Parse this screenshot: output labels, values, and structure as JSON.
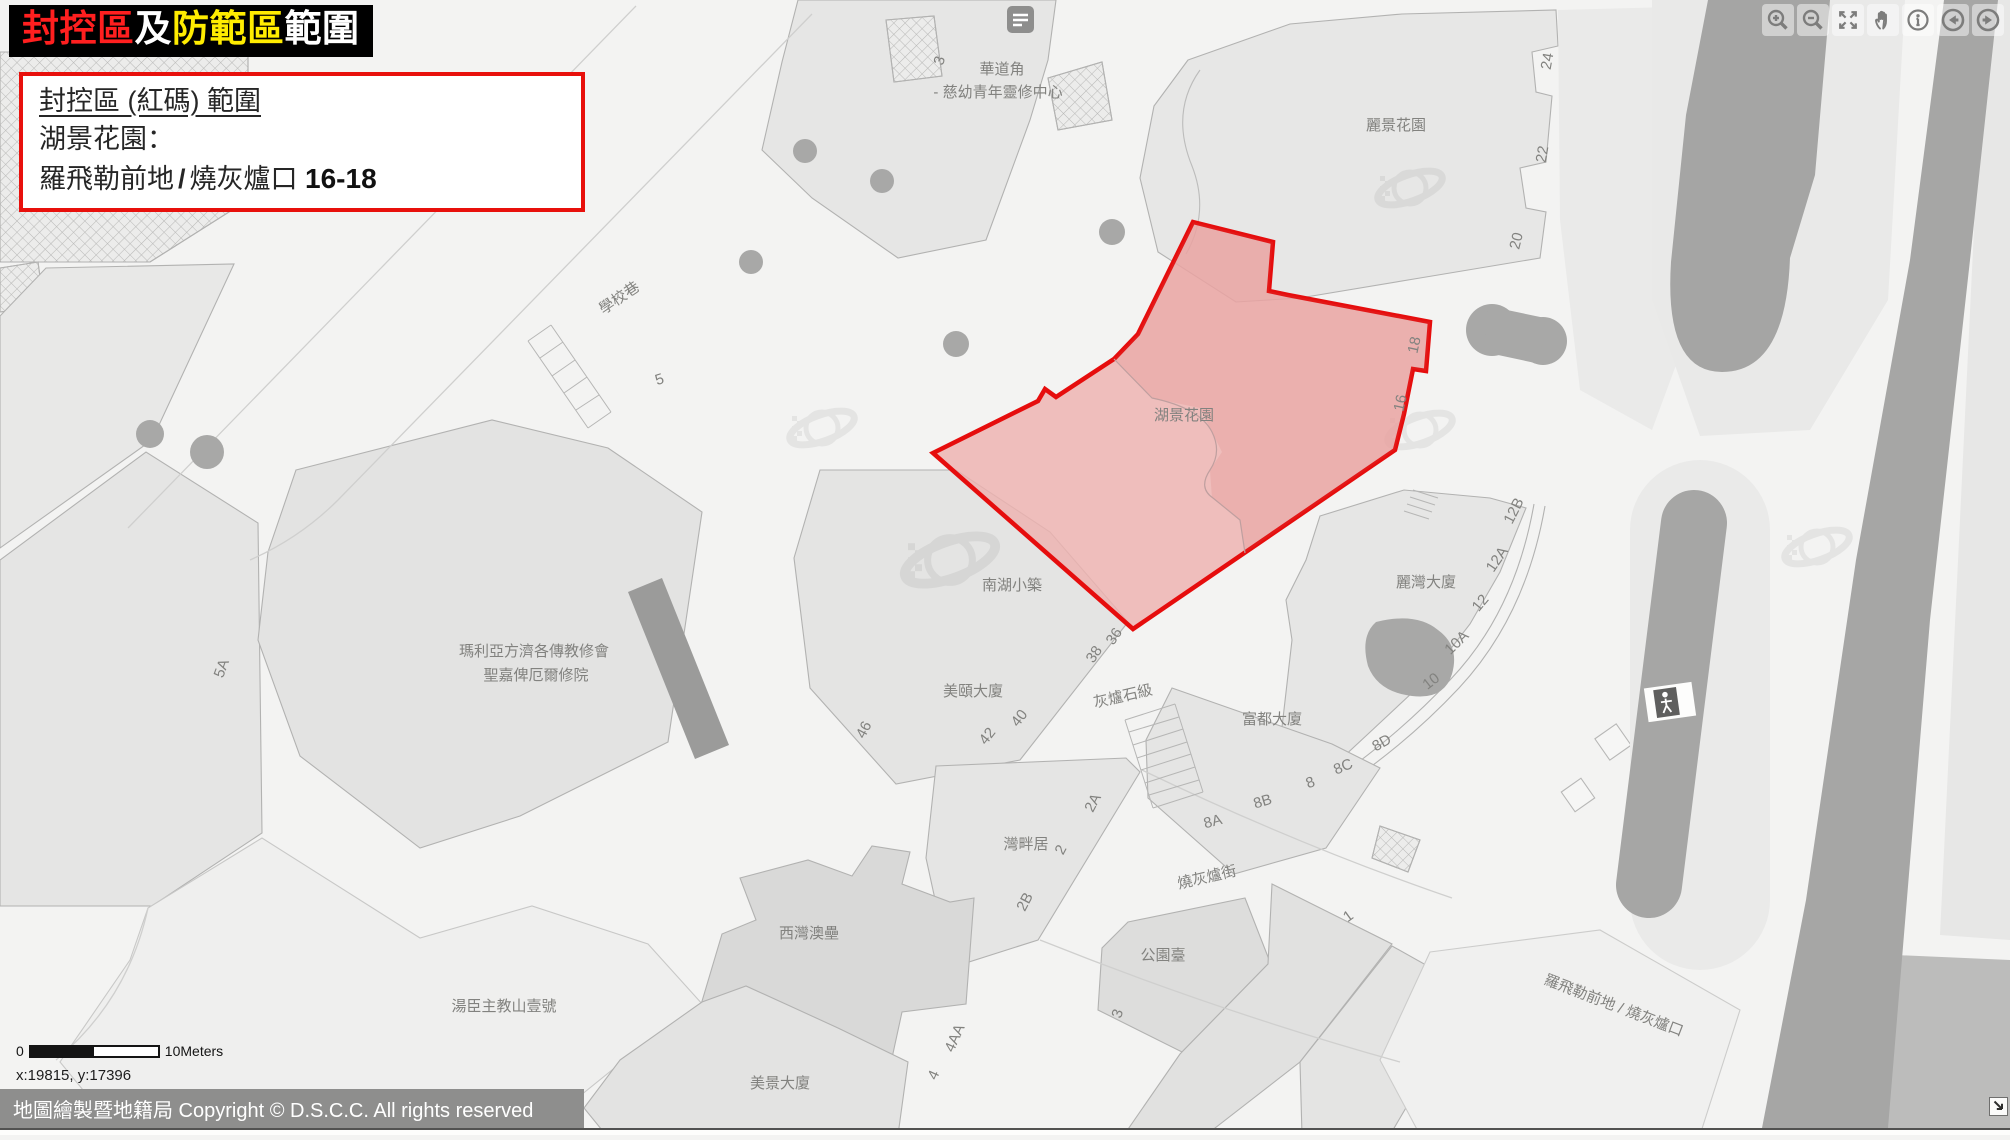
{
  "banner": {
    "segments": [
      {
        "text": "封控區",
        "color": "#ff1f1f"
      },
      {
        "text": "及",
        "color": "#ffffff"
      },
      {
        "text": "防範區",
        "color": "#ffec00"
      },
      {
        "text": "範圍",
        "color": "#ffffff"
      }
    ]
  },
  "info_box": {
    "title": "封控區 (紅碼) 範圍",
    "building": "湖景花園：",
    "street_a": "羅飛勒前地",
    "slash": "/",
    "street_b": "燒灰爐口",
    "range": "16-18"
  },
  "toolbar": {
    "buttons": [
      {
        "name": "zoom-in-button",
        "icon": "magnifier-plus-icon"
      },
      {
        "name": "zoom-out-button",
        "icon": "magnifier-minus-icon"
      },
      {
        "name": "full-extent-button",
        "icon": "expand-arrows-icon"
      },
      {
        "name": "pan-button",
        "icon": "hand-icon"
      },
      {
        "name": "identify-button",
        "icon": "info-circle-icon"
      },
      {
        "name": "previous-extent-button",
        "icon": "arrow-left-circle-icon"
      },
      {
        "name": "next-extent-button",
        "icon": "arrow-right-circle-icon"
      }
    ]
  },
  "scale_bar": {
    "zero": "0",
    "label": "10Meters"
  },
  "status": {
    "coordinates": "x:19815, y:17396"
  },
  "footer": {
    "copyright": "地圖繪製暨地籍局 Copyright © D.S.C.C. All rights reserved"
  },
  "map": {
    "zone": {
      "name": "湖景花園",
      "fill": "#eeb2b0",
      "border": "#e60d0d"
    },
    "labels": [
      {
        "t": "華道角",
        "x": 1002,
        "y": 74
      },
      {
        "t": "- 慈幼青年靈修中心",
        "x": 998,
        "y": 97
      },
      {
        "t": "3",
        "x": 944,
        "y": 62,
        "r": -72
      },
      {
        "t": "麗景花園",
        "x": 1396,
        "y": 130
      },
      {
        "t": "24",
        "x": 1552,
        "y": 62,
        "r": -80
      },
      {
        "t": "22",
        "x": 1547,
        "y": 155,
        "r": -80
      },
      {
        "t": "20",
        "x": 1521,
        "y": 242,
        "r": -76
      },
      {
        "t": "學校巷",
        "x": 622,
        "y": 302,
        "r": -34
      },
      {
        "t": "5",
        "x": 661,
        "y": 384,
        "r": -18
      },
      {
        "t": "5A",
        "x": 226,
        "y": 670,
        "r": -70
      },
      {
        "t": "瑪利亞方濟各傳教修會",
        "x": 534,
        "y": 656
      },
      {
        "t": "聖嘉俾厄爾修院",
        "x": 536,
        "y": 680
      },
      {
        "t": "湖景花園",
        "x": 1184,
        "y": 420
      },
      {
        "t": "18",
        "x": 1419,
        "y": 346,
        "r": -78,
        "c": "#6d6d6c"
      },
      {
        "t": "16",
        "x": 1405,
        "y": 404,
        "r": -78,
        "c": "#6d6d6c"
      },
      {
        "t": "南湖小築",
        "x": 1012,
        "y": 590
      },
      {
        "t": "美頤大廈",
        "x": 973,
        "y": 696
      },
      {
        "t": "46",
        "x": 868,
        "y": 732,
        "r": -62
      },
      {
        "t": "42",
        "x": 991,
        "y": 739,
        "r": -52
      },
      {
        "t": "40",
        "x": 1023,
        "y": 721,
        "r": -52
      },
      {
        "t": "38",
        "x": 1098,
        "y": 657,
        "r": -56
      },
      {
        "t": "36",
        "x": 1118,
        "y": 639,
        "r": -56
      },
      {
        "t": "灰爐石級",
        "x": 1124,
        "y": 701,
        "r": -13
      },
      {
        "t": "麗灣大廈",
        "x": 1426,
        "y": 587
      },
      {
        "t": "12B",
        "x": 1518,
        "y": 513,
        "r": -63
      },
      {
        "t": "12A",
        "x": 1501,
        "y": 562,
        "r": -56
      },
      {
        "t": "12",
        "x": 1484,
        "y": 606,
        "r": -50
      },
      {
        "t": "10A",
        "x": 1460,
        "y": 646,
        "r": -44
      },
      {
        "t": "10",
        "x": 1434,
        "y": 685,
        "r": -38
      },
      {
        "t": "8D",
        "x": 1384,
        "y": 747,
        "r": -29
      },
      {
        "t": "8C",
        "x": 1345,
        "y": 771,
        "r": -23
      },
      {
        "t": "8",
        "x": 1312,
        "y": 787,
        "r": -21
      },
      {
        "t": "8B",
        "x": 1264,
        "y": 806,
        "r": -17
      },
      {
        "t": "8A",
        "x": 1214,
        "y": 826,
        "r": -15
      },
      {
        "t": "富都大廈",
        "x": 1272,
        "y": 724
      },
      {
        "t": "灣畔居",
        "x": 1026,
        "y": 849
      },
      {
        "t": "2A",
        "x": 1097,
        "y": 805,
        "r": -62
      },
      {
        "t": "2",
        "x": 1065,
        "y": 852,
        "r": -62
      },
      {
        "t": "2B",
        "x": 1029,
        "y": 904,
        "r": -62
      },
      {
        "t": "燒灰爐街",
        "x": 1208,
        "y": 882,
        "r": -13
      },
      {
        "t": "公園臺",
        "x": 1163,
        "y": 960
      },
      {
        "t": "1",
        "x": 1351,
        "y": 920,
        "r": -36
      },
      {
        "t": "3",
        "x": 1122,
        "y": 1015,
        "r": -72
      },
      {
        "t": "西灣澳壘",
        "x": 809,
        "y": 938
      },
      {
        "t": "4AA",
        "x": 959,
        "y": 1040,
        "r": -66
      },
      {
        "t": "4",
        "x": 938,
        "y": 1077,
        "r": -66
      },
      {
        "t": "湯臣主教山壹號",
        "x": 504,
        "y": 1011
      },
      {
        "t": "美景大廈",
        "x": 780,
        "y": 1088
      },
      {
        "t": "羅飛勒前地 / 燒灰爐口",
        "x": 1612,
        "y": 1010,
        "r": 21
      }
    ]
  }
}
